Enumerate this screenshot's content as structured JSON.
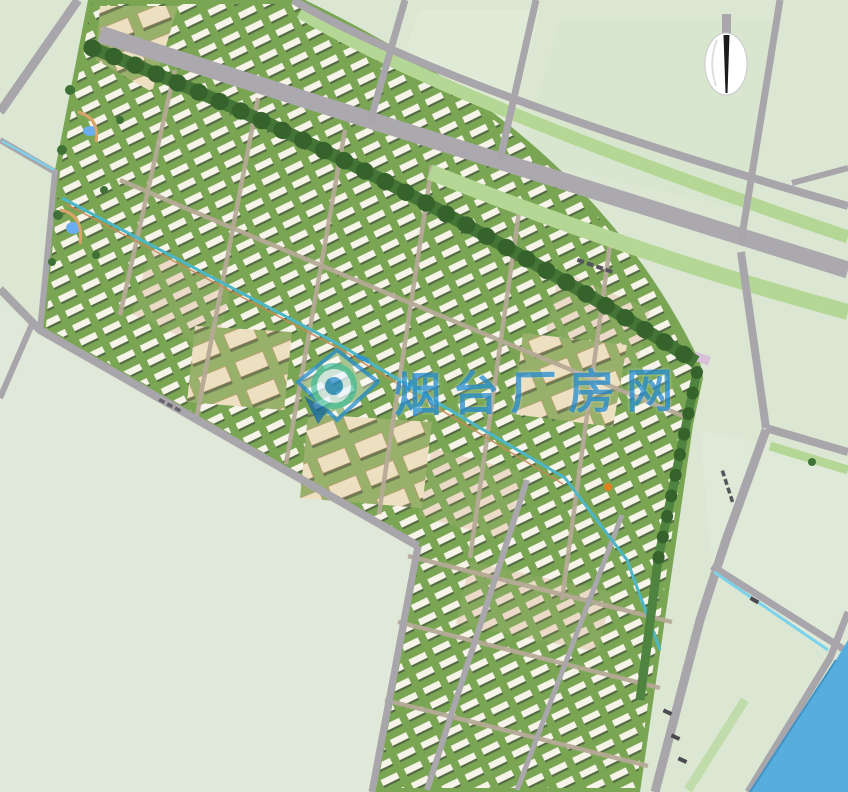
{
  "map": {
    "type": "urban-master-plan-rendering",
    "watermark": {
      "logo_icon": "blue-diamond-lens-logo",
      "text": "烟台厂房网",
      "color": "#1a86cd"
    },
    "compass": {
      "icon": "north-arrow"
    },
    "features": {
      "boulevard": "main diagonal road with green median",
      "river": "blue river in bottom-right corner",
      "water_axis": "teal linear water feature through residential blocks",
      "blocks": "rows of low residential buildings with green courts",
      "public_buildings": "large cream buildings in central-west blocks",
      "empty_field": "large pale green field bottom-left"
    },
    "palette": {
      "field": "#dbe7d2",
      "field_southwest": "#e0e8da",
      "road": "#a8a5ab",
      "median_green": "#b4d795",
      "block_green": "#7aa654",
      "tree_green": "#447537",
      "building": "#f6f3e8",
      "building_alt": "#ecdac9",
      "public_building": "#ede0c0",
      "river": "#57aedd",
      "canal": "#7cd2ea",
      "water_axis": "#4db6c6",
      "watermark_blue": "#1a86cd"
    }
  }
}
